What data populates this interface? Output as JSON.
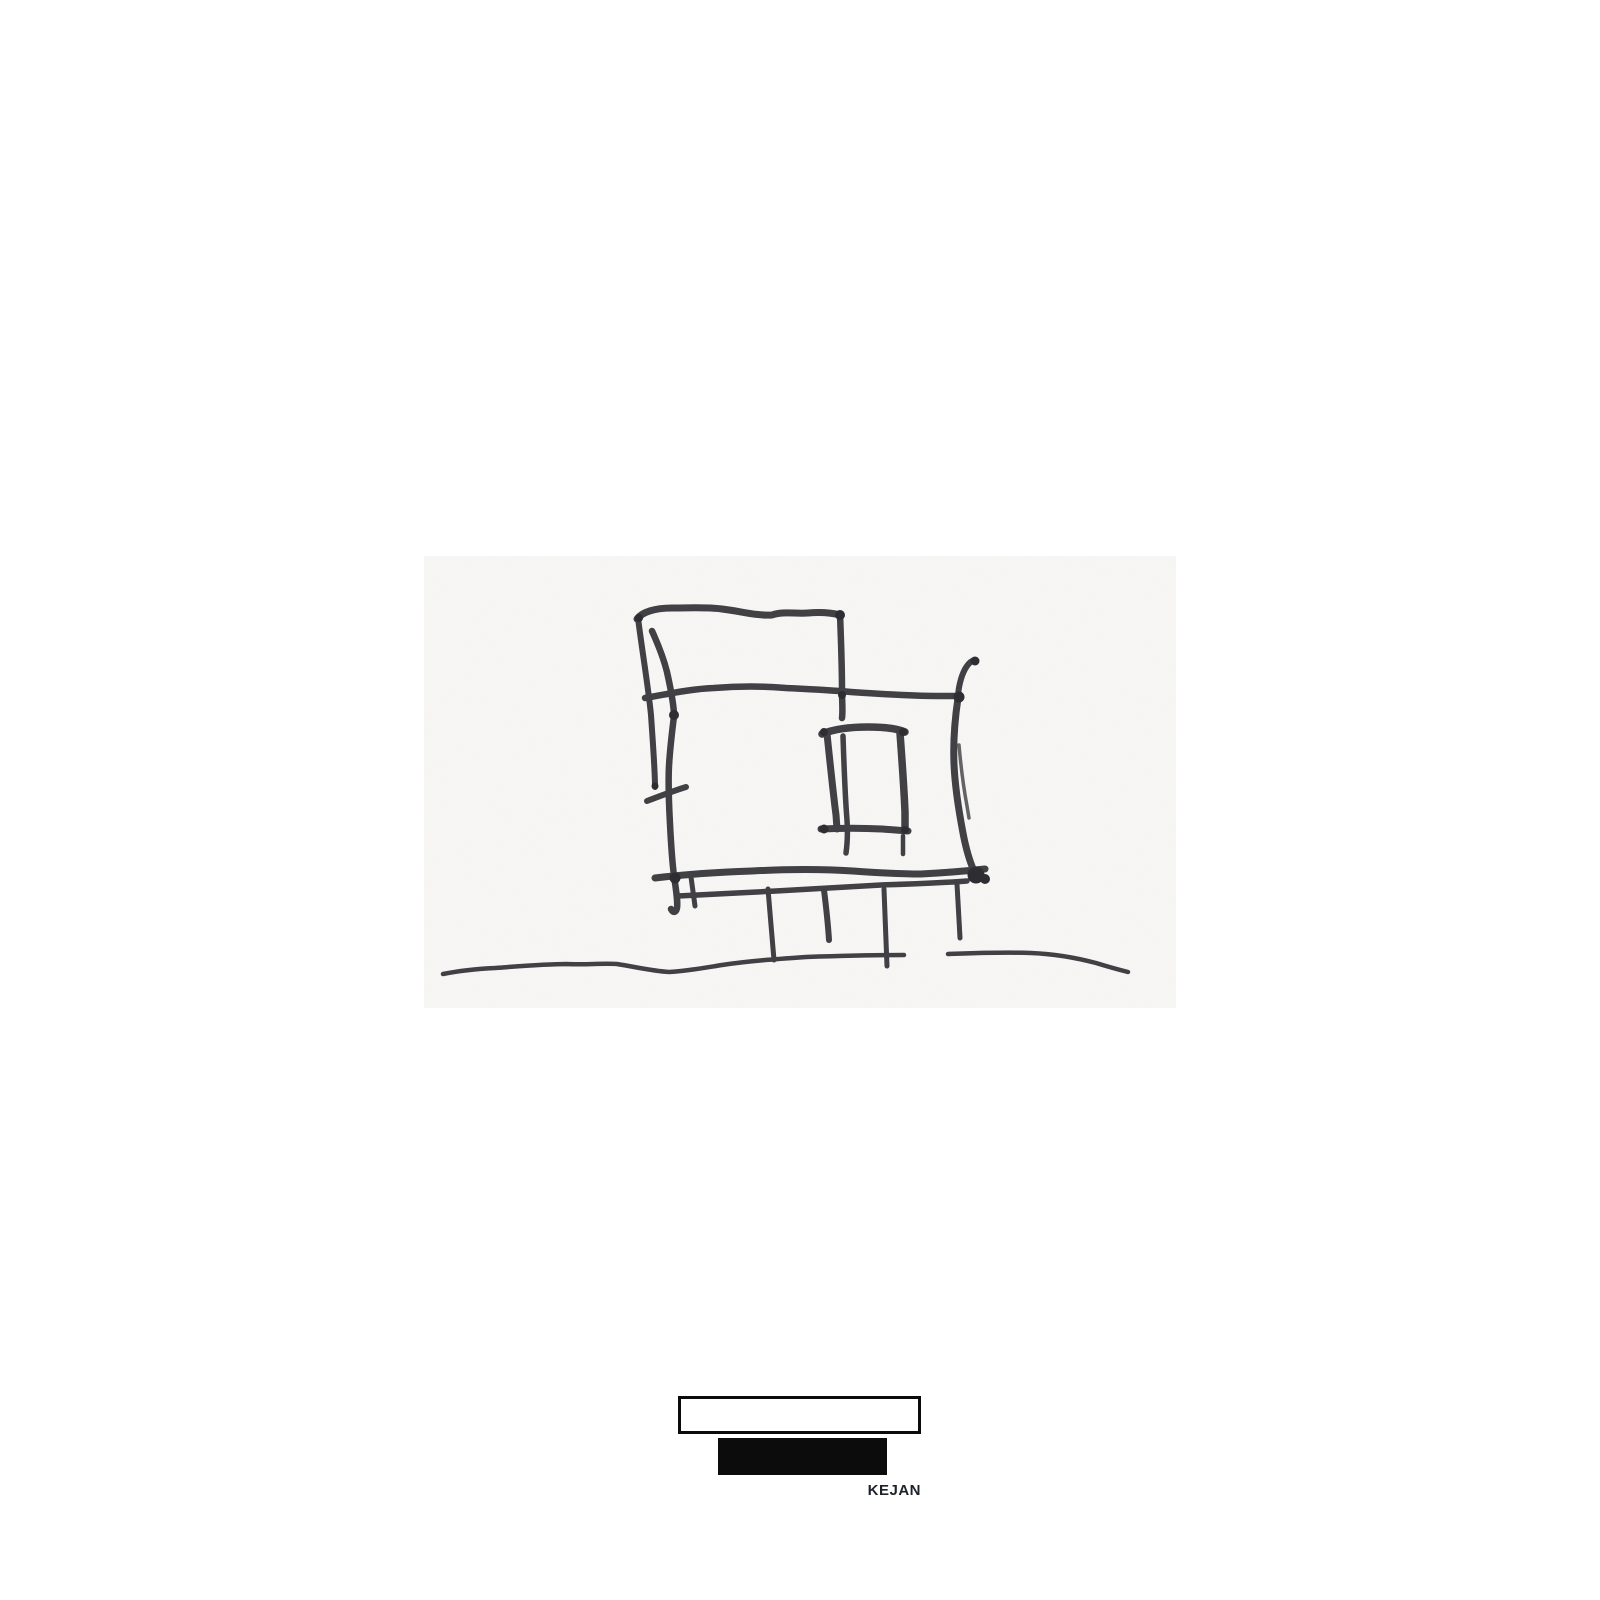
{
  "page": {
    "background": "#ffffff",
    "width": 1600,
    "height": 1600
  },
  "sketch": {
    "subject": "freehand black-marker concept sketch of a modern house elevation on off-white paper",
    "paper_color": "#f8f7f5",
    "ink_color": "#3f3f44",
    "knot_color": "#2e2e32",
    "strokes": [
      {
        "name": "top-box-top-edge",
        "d": "M637,619 C642,612 655,608 672,608 C692,608 706,607 722,609 C740,611 756,616 772,615 C783,611 795,614 808,613 C820,612 832,613 840,615",
        "w": 7
      },
      {
        "name": "top-box-left-vertical",
        "d": "M638,618 C642,650 648,685 651,715 C653,745 655,770 655,787",
        "w": 6
      },
      {
        "name": "top-box-right-vertical",
        "d": "M840,614 C841,640 842,665 842,690 C842,702 843,711 842,718",
        "w": 6.5
      },
      {
        "name": "main-left-edge",
        "d": "M652,631 C657,642 663,656 667,672 C671,690 674,705 674,716 C672,732 670,748 669,766 C668,786 669,806 670,824 C671,844 672,860 674,876 C676,890 678,901 677,908 C676,913 673,913 671,909",
        "w": 6.5
      },
      {
        "name": "left-tick",
        "d": "M647,801 C660,796 673,791 686,787",
        "w": 6
      },
      {
        "name": "mid-horizontal",
        "d": "M645,698 C668,694 690,689 714,688 C740,686 762,686 786,688 C806,689 828,690 851,692 C880,694 912,696 936,696 L957,696",
        "w": 6.5
      },
      {
        "name": "right-top-hook",
        "d": "M975,660 C969,661 964,669 961,679 C959,686 958,692 958,698",
        "w": 6
      },
      {
        "name": "right-edge-main",
        "d": "M958,698 C955,718 953,740 954,764 C955,788 959,812 963,833 C966,849 970,862 974,871",
        "w": 7
      },
      {
        "name": "right-edge-double",
        "d": "M959,745 C961,768 964,790 967,806 L969,818",
        "w": 3.5,
        "o": 0.8
      },
      {
        "name": "platform-top-line",
        "d": "M655,878 C688,874 722,872 752,871 C790,869 822,869 853,871 C881,873 902,874 921,874 C941,873 966,871 985,869",
        "w": 7
      },
      {
        "name": "platform-bottom-line",
        "d": "M678,896 C712,894 742,893 776,891 C812,889 846,887 881,885 C911,884 941,883 967,881",
        "w": 5.5
      },
      {
        "name": "platform-left-post",
        "d": "M691,877 L695,906",
        "w": 5
      },
      {
        "name": "leg-1",
        "d": "M768,889 C770,912 772,938 774,960",
        "w": 5
      },
      {
        "name": "leg-2",
        "d": "M824,890 C826,906 828,924 829,940",
        "w": 6
      },
      {
        "name": "leg-3",
        "d": "M884,889 C885,914 886,942 887,966",
        "w": 5
      },
      {
        "name": "leg-4",
        "d": "M957,884 C958,901 959,920 960,938",
        "w": 5
      },
      {
        "name": "window-top",
        "d": "M822,734 C834,729 851,727 868,727 C885,727 898,729 905,732",
        "w": 7.5
      },
      {
        "name": "window-left-outer",
        "d": "M827,734 C830,762 833,792 836,815 L837,829",
        "w": 7
      },
      {
        "name": "window-left-inner",
        "d": "M843,736 C844,766 845,796 847,820 C848,836 847,846 846,853",
        "w": 5.5
      },
      {
        "name": "window-right",
        "d": "M900,733 C902,760 904,788 905,812 L905,829",
        "w": 7.5
      },
      {
        "name": "window-bottom",
        "d": "M821,829 C841,828 862,828 882,829 L908,831",
        "w": 7
      },
      {
        "name": "window-right-tail",
        "d": "M903,836 L903,854",
        "w": 4.5
      },
      {
        "name": "ground-line-left",
        "d": "M443,974 C458,971 475,969 495,968 C522,966 546,964 567,964 C586,965 602,963 617,964 C636,967 652,971 669,972 C687,971 703,968 722,965 C748,961 777,959 806,957 C838,956 872,955 904,955",
        "w": 4.5
      },
      {
        "name": "ground-line-right",
        "d": "M948,954 C976,953 1002,952 1031,953 C1056,954 1077,958 1096,963 C1109,967 1120,970 1128,972",
        "w": 4.5
      }
    ],
    "knots": [
      {
        "cx": 639,
        "cy": 618,
        "r": 4
      },
      {
        "cx": 840,
        "cy": 615,
        "r": 5
      },
      {
        "cx": 674,
        "cy": 715,
        "r": 5
      },
      {
        "cx": 655,
        "cy": 786,
        "r": 3.5
      },
      {
        "cx": 842,
        "cy": 695,
        "r": 4
      },
      {
        "cx": 975,
        "cy": 661,
        "r": 4.5
      },
      {
        "cx": 959,
        "cy": 697,
        "r": 5.5
      },
      {
        "cx": 976,
        "cy": 875,
        "r": 8.5
      },
      {
        "cx": 985,
        "cy": 879,
        "r": 5
      },
      {
        "cx": 675,
        "cy": 878,
        "r": 5.5
      },
      {
        "cx": 824,
        "cy": 732,
        "r": 4
      },
      {
        "cx": 903,
        "cy": 732,
        "r": 4
      },
      {
        "cx": 824,
        "cy": 829,
        "r": 4.5
      },
      {
        "cx": 905,
        "cy": 830,
        "r": 4
      }
    ]
  },
  "footer_logo": {
    "brand_name": "KEJAN",
    "outline_box_border_color": "#0b0b0b",
    "solid_box_color": "#0c0c0c",
    "brand_text_color": "#1d2129"
  }
}
